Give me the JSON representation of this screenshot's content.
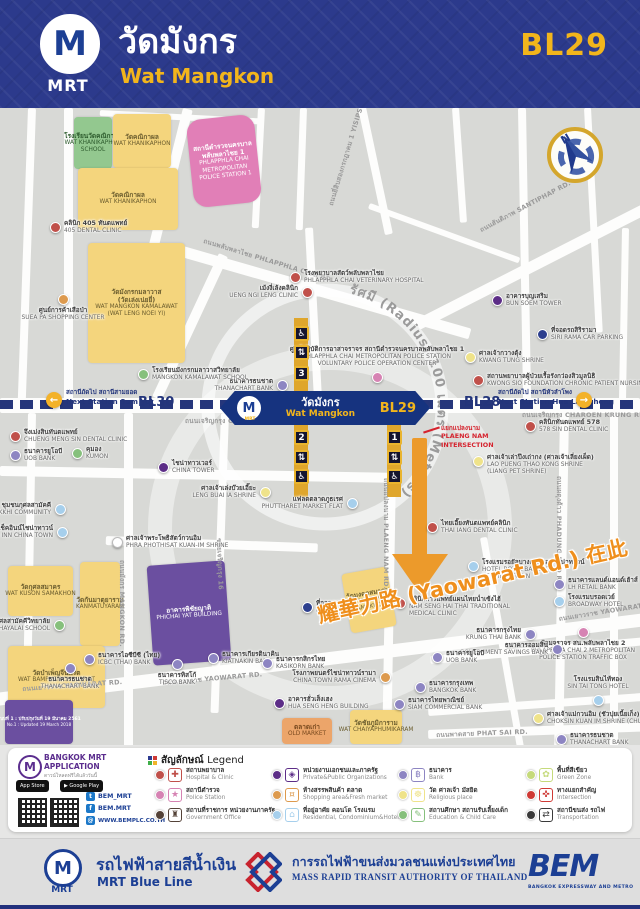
{
  "header": {
    "title_th": "วัดมังกร",
    "title_en": "Wat Mangkon",
    "station_code": "BL29",
    "logo_m": "M",
    "logo_mrt": "MRT"
  },
  "map": {
    "radius_label": "รัศมี (Radius) 100 เมตร (Meters)",
    "compass_n": "N",
    "station": {
      "m": "M",
      "mrt": "MRT",
      "th": "วัดมังกร",
      "en": "Wat Mangkon",
      "code": "BL29"
    },
    "line": {
      "prev_code": "BL30",
      "next_code": "BL28",
      "prev_th": "สถานีถัดไป สถานีสามยอด",
      "prev_en": "Next Station Sam Yot",
      "next_th": "สถานีถัดไป สถานีหัวลำโพง",
      "next_en": "Next Station Hua Lamphong",
      "arrow_left": "←",
      "arrow_right": "→"
    },
    "intersection": {
      "lines": [
        "แยกแปลงนาม",
        "PLAENG NAM",
        "INTERSECTION"
      ]
    },
    "yaowarat_callout": "耀華力路 (Yaowarat Rd.) 在此",
    "note_th": "แบบที่ 1 : ปรับปรุงวันที่ 19 มีนาคม 2561",
    "note_en": "No.1 : Updated 19 March 2018",
    "colors": {
      "hospital": "#c0504a",
      "police": "#d683b3",
      "government": "#544238",
      "private": "#5c2d87",
      "shopping": "#dd9a4e",
      "residential": "#a6cfec",
      "bank": "#8d85c2",
      "religious": "#efe38a",
      "education": "#86c07c",
      "green": "#c5da7b",
      "intersection": "#cf3a35",
      "transport": "#3a3a3a",
      "parking": "#2d3f8e",
      "shrine": "#ffffff"
    },
    "roads": [
      [
        28,
        0,
        8,
        292,
        2
      ],
      [
        64,
        0,
        9,
        292,
        0
      ],
      [
        183,
        0,
        10,
        150,
        14
      ],
      [
        219,
        145,
        10,
        158,
        25
      ],
      [
        358,
        0,
        8,
        130,
        -12
      ],
      [
        258,
        0,
        7,
        120,
        3
      ],
      [
        305,
        120,
        8,
        175,
        -3
      ],
      [
        300,
        0,
        7,
        122,
        2
      ],
      [
        452,
        0,
        7,
        115,
        -4
      ],
      [
        518,
        0,
        8,
        295,
        -1
      ],
      [
        584,
        0,
        7,
        225,
        -3
      ],
      [
        622,
        120,
        7,
        175,
        1
      ],
      [
        415,
        212,
        255,
        11,
        -27
      ],
      [
        183,
        138,
        300,
        11,
        16
      ],
      [
        370,
        95,
        160,
        6,
        20
      ],
      [
        100,
        2,
        160,
        6,
        3
      ],
      [
        0,
        290,
        640,
        15,
        0
      ],
      [
        28,
        305,
        8,
        300,
        1
      ],
      [
        124,
        305,
        9,
        340,
        0
      ],
      [
        221,
        305,
        8,
        300,
        2
      ],
      [
        388,
        305,
        9,
        300,
        1
      ],
      [
        560,
        305,
        9,
        345,
        1
      ],
      [
        610,
        305,
        8,
        340,
        0
      ],
      [
        0,
        358,
        392,
        10,
        1
      ],
      [
        106,
        428,
        212,
        9,
        2
      ],
      [
        -5,
        585,
        660,
        13,
        -7
      ],
      [
        428,
        622,
        215,
        9,
        -2
      ],
      [
        430,
        548,
        215,
        8,
        -5
      ],
      [
        428,
        600,
        218,
        8,
        -4
      ],
      [
        480,
        430,
        7,
        230,
        -10
      ]
    ],
    "road_labels": [
      {
        "x": 205,
        "y": 128,
        "r": 17,
        "t": "ถนนพลับพลาไชย PHLAPPHLA CHAI RD."
      },
      {
        "x": 326,
        "y": 96,
        "r": -73,
        "t": "ถนนยี่สิบสองกรกฎาคม 1 YISIPSONG KARAKADAKHOM 1 RD."
      },
      {
        "x": 478,
        "y": 118,
        "r": -28,
        "t": "ถนนสันติภาพ SANTIPHAP RD."
      },
      {
        "x": 185,
        "y": 308,
        "r": 0,
        "t": "ถนนเจริญกรุง CHAROEN KRUNG RD."
      },
      {
        "x": 522,
        "y": 302,
        "r": 0,
        "t": "ถนนเจริญกรุง CHAROEN KRUNG RD."
      },
      {
        "x": 22,
        "y": 576,
        "r": -4,
        "t": "ถนนเยาวราช YAOWARAT RD."
      },
      {
        "x": 162,
        "y": 570,
        "r": -5,
        "t": "ถนนเยาวราช YAOWARAT RD."
      },
      {
        "x": 558,
        "y": 506,
        "r": -9,
        "t": "ถนนเยาวราช YAOWARAT RD."
      },
      {
        "x": 391,
        "y": 370,
        "r": 90,
        "t": "ถนนแปลงนาม PLAENG NAM RD."
      },
      {
        "x": 564,
        "y": 368,
        "r": 90,
        "t": "ถนนผดุงด้าว PHADUNG DAO RD."
      },
      {
        "x": 127,
        "y": 452,
        "r": 90,
        "t": "ถนนมังกร MANGKON RD."
      },
      {
        "x": 224,
        "y": 430,
        "r": 88,
        "t": "ซอยเจริญกรุง 16"
      },
      {
        "x": 436,
        "y": 622,
        "r": -2,
        "t": "ถนนพาดสาย PHAT SAI RD."
      }
    ],
    "buildings": [
      {
        "x": 74,
        "y": 9,
        "w": 38,
        "h": 52,
        "c": "school",
        "th": "โรงเรียนวัดคณิกาผล",
        "en": "WAT KHANIKAPHON|SCHOOL"
      },
      {
        "x": 113,
        "y": 6,
        "w": 58,
        "h": 54,
        "c": "temple",
        "th": "วัดคณิกาผล",
        "en": "WAT KHANIKAPHON"
      },
      {
        "x": 78,
        "y": 60,
        "w": 100,
        "h": 62,
        "c": "temple",
        "th": "วัดคณิกาผล",
        "en": "WAT KHANIKAPHON"
      },
      {
        "x": 190,
        "y": 9,
        "w": 68,
        "h": 88,
        "c": "police",
        "rot": -6,
        "r": 14,
        "th": "สถานีตำรวจนครบาล|พลับพลาไชย 1",
        "en": "PHLAPPHLA CHAI|METROPOLITAN|POLICE STATION 1"
      },
      {
        "x": 88,
        "y": 135,
        "w": 97,
        "h": 120,
        "c": "temple",
        "th": "วัดมังกรกมลาวาส|(วัดเล่งเน่ยยี่)",
        "en": "WAT MANGKON KAMALAWAT|(WAT LENG NOEI YI)"
      },
      {
        "x": 150,
        "y": 455,
        "w": 78,
        "h": 100,
        "c": "purple",
        "rot": -4,
        "th": "อาคารพิชัยญาติ",
        "en": "PHICHAI YAT BUILDING"
      },
      {
        "x": 8,
        "y": 458,
        "w": 65,
        "h": 50,
        "c": "temple",
        "th": "วัดกุศลสมาคร",
        "en": "WAT KUSON SAMAKHON"
      },
      {
        "x": 80,
        "y": 454,
        "w": 40,
        "h": 84,
        "c": "temple",
        "th": "วัดกันมาตุยาราม",
        "en": "KANMATUYARAM"
      },
      {
        "x": 8,
        "y": 538,
        "w": 97,
        "h": 62,
        "c": "temple",
        "th": "วัดบำเพ็ญจีนพรต",
        "en": "WAT BAMPHEN CHIN PROT"
      },
      {
        "x": 5,
        "y": 592,
        "w": 68,
        "h": 44,
        "c": "purple",
        "note": true
      },
      {
        "x": 346,
        "y": 462,
        "w": 46,
        "h": 60,
        "c": "temple",
        "rot": -10,
        "th": "วัดมงคลสมาคม",
        "en": "WAT MONGKHON|SAMAKHOM"
      },
      {
        "x": 350,
        "y": 602,
        "w": 52,
        "h": 34,
        "c": "temple",
        "th": "วัดชัยภูมิการาม",
        "en": "WAT CHAIYAPHUMIKARAM"
      },
      {
        "x": 282,
        "y": 610,
        "w": 50,
        "h": 26,
        "c": "market",
        "th": "ตลาดเก่า",
        "en": "OLD MARKET"
      }
    ],
    "pois": [
      {
        "x": 55,
        "y": 119,
        "c": "hospital",
        "th": "คลินิก 405 ทันตแพทย์",
        "en": "405 DENTAL CLINIC"
      },
      {
        "x": 63,
        "y": 191,
        "c": "shopping",
        "s": "b",
        "th": "ศูนย์การค้าเสือป่า",
        "en": "SUEA PA SHOPPING CENTER"
      },
      {
        "x": 295,
        "y": 169,
        "c": "hospital",
        "th": "โรงพยาบาลสัตว์พลับพลาไชย",
        "en": "PHLAPPHLA CHAI VETERINARY HOSPITAL"
      },
      {
        "x": 307,
        "y": 184,
        "c": "hospital",
        "s": "l",
        "th": "เม้งงี่เล้งคลินิก",
        "en": "UENG NGI LENG CLINIC"
      },
      {
        "x": 497,
        "y": 192,
        "c": "private",
        "th": "อาคารบุญเสริม",
        "en": "BUN SOEM TOWER"
      },
      {
        "x": 542,
        "y": 226,
        "c": "parking",
        "th": "ที่จอดรถสิริรามา",
        "en": "SIRI RAMA CAR PARKING"
      },
      {
        "x": 470,
        "y": 249,
        "c": "religious",
        "th": "ศาลเจ้ากวางตุ้ง",
        "en": "KWANG TUNG SHRINE"
      },
      {
        "x": 478,
        "y": 272,
        "c": "hospital",
        "th": "สถานพยาบาลผู้ป่วยเรื้อรังกว่องสิวมูลนิธิ",
        "en": "KWONG SIO FOUNDATION CHRONIC PATIENT NURSING HOME"
      },
      {
        "x": 282,
        "y": 277,
        "c": "bank",
        "s": "l",
        "th": "ธนาคารธนชาต",
        "en": "THANACHART BANK"
      },
      {
        "x": 143,
        "y": 266,
        "c": "education",
        "th": "โรงเรียนมังกรกมลาวาสวิทยาลัย",
        "en": "MANGKON KAMALAWAT SCHOOL"
      },
      {
        "x": 377,
        "y": 269,
        "c": "police",
        "s": "a",
        "th": "ศูนย์ปฏิบัติการอาสาจราจร สถานีตำรวจนครบาลพลับพลาไชย 1",
        "en": "PHLAPPHLA CHAI METROPOLITAN POLICE STATION|VOLUNTARY POLICE OPERATION CENTER"
      },
      {
        "x": 530,
        "y": 318,
        "c": "hospital",
        "th": "คลินิกทันตแพทย์ 578",
        "en": "578 SIN DENTAL CLINIC"
      },
      {
        "x": 15,
        "y": 328,
        "c": "hospital",
        "th": "จึงเม่งสินทันตแพทย์",
        "en": "CHUENG MENG SIN DENTAL CLINIC"
      },
      {
        "x": 15,
        "y": 347,
        "c": "bank",
        "th": "ธนาคารยูโอบี",
        "en": "UOB BANK"
      },
      {
        "x": 77,
        "y": 345,
        "c": "education",
        "th": "คุมอง",
        "en": "KUMON"
      },
      {
        "x": 163,
        "y": 359,
        "c": "private",
        "th": "ไชน่าทาวเวอร์",
        "en": "CHINA TOWER"
      },
      {
        "x": 60,
        "y": 401,
        "c": "residential",
        "s": "l",
        "th": "ชุมชนกุศลสามัคคี",
        "en": "KHUSON SAMAKKHI COMMUNITY"
      },
      {
        "x": 62,
        "y": 424,
        "c": "residential",
        "s": "l",
        "th": "เช็คอินน์ไชน่าทาวน์",
        "en": "CHECK INN CHINA TOWN"
      },
      {
        "x": 265,
        "y": 384,
        "c": "religious",
        "s": "l",
        "th": "ศาลเจ้าเล่งบ๊วยเอี๊ยะ",
        "en": "LENG BUAI IA SHRINE"
      },
      {
        "x": 117,
        "y": 434,
        "c": "shrine",
        "th": "ศาลเจ้าพระโพธิสัตว์กวนอิม",
        "en": "PHRA PHOTHISAT KUAN-IM SHRINE"
      },
      {
        "x": 352,
        "y": 395,
        "c": "residential",
        "s": "l",
        "th": "แฟลตตลาดภูธเรศ",
        "en": "PHUTTHARET MARKET FLAT"
      },
      {
        "x": 478,
        "y": 353,
        "c": "religious",
        "th": "ศาลเจ้าเล่าปึงเถ่ากง (ศาลเจ้าเลี่ยงเผ็ด)",
        "en": "LAO PUENG THAO KONG SHRINE|(LIANG PET SHRINE)"
      },
      {
        "x": 432,
        "y": 419,
        "c": "hospital",
        "th": "ไทยเอี๊ยงทันตแพทย์คลินิก",
        "en": "THAI IANG DENTAL CLINIC"
      },
      {
        "x": 473,
        "y": 458,
        "c": "residential",
        "th": "โรงแรมรอยัลบางกอกแอทไชน่าทาวน์",
        "en": "HOTEL ROYAL BANGKOK|AT CHINA TOWN"
      },
      {
        "x": 559,
        "y": 476,
        "c": "bank",
        "th": "ธนาคารแลนด์แอนด์เฮ้าส์",
        "en": "LH RETAIL BANK"
      },
      {
        "x": 559,
        "y": 493,
        "c": "residential",
        "th": "โรงแรมบรอดเวย์",
        "en": "BROADWAY HOTEL"
      },
      {
        "x": 400,
        "y": 495,
        "c": "hospital",
        "th": "คลินิกการแพทย์แผนไทยน่ำเซ้งไฮ้",
        "en": "NAM SENG HAI THAI TRADITIONAL|MEDICAL CLINIC"
      },
      {
        "x": 530,
        "y": 526,
        "c": "bank",
        "s": "l",
        "th": "ธนาคารกรุงไทย",
        "en": "KRUNG THAI BANK"
      },
      {
        "x": 583,
        "y": 524,
        "c": "police",
        "s": "b",
        "th": "ป้อมจราจร สน.พลับพลาไชย 2",
        "en": "PHLAPPHLA CHAI 2 METROPOLITAN|POLICE STATION TRAFFIC BOX"
      },
      {
        "x": 557,
        "y": 541,
        "c": "bank",
        "s": "l",
        "th": "ธนาคารออมสิน",
        "en": "GOVERNMENT SAVINGS BANK"
      },
      {
        "x": 437,
        "y": 549,
        "c": "bank",
        "th": "ธนาคารยูโอบี",
        "en": "UOB BANK"
      },
      {
        "x": 420,
        "y": 579,
        "c": "bank",
        "th": "ธนาคารกรุงเทพ",
        "en": "BANGKOK BANK"
      },
      {
        "x": 399,
        "y": 596,
        "c": "bank",
        "th": "ธนาคารไทยพาณิชย์",
        "en": "SIAM COMMERCIAL BANK"
      },
      {
        "x": 385,
        "y": 569,
        "c": "shopping",
        "s": "l",
        "th": "โรงภาพยนตร์ไชน่าทาวน์รามา",
        "en": "CHINA TOWN RAMA CINEMA"
      },
      {
        "x": 598,
        "y": 592,
        "c": "residential",
        "s": "a",
        "th": "โรงแรมสินไท้ทอง",
        "en": "SIN TAI TONG HOTEL"
      },
      {
        "x": 538,
        "y": 610,
        "c": "religious",
        "th": "ศาลเจ้าแม่กวนอิม (ชัวปุยเนี้ยเก็ง)",
        "en": "CHOKSIN KUAN IM SHRINE (CHUA PUI NIA YIA)"
      },
      {
        "x": 561,
        "y": 631,
        "c": "bank",
        "th": "ธนาคารธนชาต",
        "en": "THANACHART BANK"
      },
      {
        "x": 279,
        "y": 595,
        "c": "private",
        "th": "อาคารฮั่วเส็งเฮง",
        "en": "HUA SENG HENG BUILDING"
      },
      {
        "x": 307,
        "y": 499,
        "c": "parking",
        "th": "ที่จอดรถ",
        "en": "PARKING"
      },
      {
        "x": 59,
        "y": 517,
        "c": "education",
        "s": "l",
        "th": "โรงเรียนกุศลสามัคคีวิทยาลัย",
        "en": "KUSONSAMAKKHI WITTHAYALAI SCHOOL"
      },
      {
        "x": 89,
        "y": 551,
        "c": "bank",
        "th": "ธนาคารไอซีบีซี (ไทย)",
        "en": "ICBC (THAI) BANK"
      },
      {
        "x": 70,
        "y": 560,
        "c": "bank",
        "s": "b",
        "th": "ธนาคารธนชาต",
        "en": "THANACHART BANK"
      },
      {
        "x": 177,
        "y": 556,
        "c": "bank",
        "s": "b",
        "th": "ธนาคารทิสโก้",
        "en": "TISCO BANK"
      },
      {
        "x": 213,
        "y": 550,
        "c": "bank",
        "th": "ธนาคารเกียรตินาคิน",
        "en": "KIATNAKIN BANK"
      },
      {
        "x": 267,
        "y": 555,
        "c": "bank",
        "th": "ธนาคารกสิกรไทย",
        "en": "KASIKORN BANK"
      }
    ],
    "exits": [
      {
        "n": "3",
        "x": 294,
        "stemY": 210,
        "stemH": 76,
        "order": [
          "wc",
          "lift",
          "num"
        ],
        "iconY": [
          218,
          237,
          258
        ]
      },
      {
        "n": "2",
        "x": 294,
        "stemY": 317,
        "stemH": 72,
        "order": [
          "num",
          "lift",
          "wc"
        ],
        "iconY": [
          322,
          342,
          361
        ]
      },
      {
        "n": "1",
        "x": 387,
        "stemY": 317,
        "stemH": 72,
        "order": [
          "num",
          "lift",
          "wc"
        ],
        "iconY": [
          322,
          342,
          361
        ]
      }
    ]
  },
  "icons": {
    "wheelchair": "♿",
    "elevator": "⇅",
    "twitter": "t",
    "facebook": "f",
    "web": "@",
    "legend_hospital": "✚",
    "legend_police": "★",
    "legend_government": "♜",
    "legend_private": "◈",
    "legend_shopping": "¤",
    "legend_residential": "⌂",
    "legend_bank": "฿",
    "legend_religious": "☸",
    "legend_education": "✎",
    "legend_green": "✿",
    "legend_intersection": "✜",
    "legend_transport": "⇄"
  },
  "legend": {
    "title_th": "สัญลักษณ์",
    "title_en": "Legend",
    "items": [
      {
        "col": 0,
        "row": 0,
        "c": "hospital",
        "ic": "legend_hospital",
        "th": "สถานพยาบาล",
        "en": "Hospital & Clinic"
      },
      {
        "col": 0,
        "row": 1,
        "c": "police",
        "ic": "legend_police",
        "th": "สถานีตำรวจ",
        "en": "Police Station"
      },
      {
        "col": 0,
        "row": 2,
        "c": "government",
        "ic": "legend_government",
        "th": "สถานที่ราชการ หน่วยงานภาครัฐ",
        "en": "Government Office"
      },
      {
        "col": 1,
        "row": 0,
        "c": "private",
        "ic": "legend_private",
        "th": "หน่วยงานเอกชนและภาครัฐ",
        "en": "Private&Public Organizations"
      },
      {
        "col": 1,
        "row": 1,
        "c": "shopping",
        "ic": "legend_shopping",
        "th": "ห้างสรรพสินค้า ตลาด",
        "en": "Shopping area&Fresh market"
      },
      {
        "col": 1,
        "row": 2,
        "c": "residential",
        "ic": "legend_residential",
        "th": "ที่อยู่อาศัย คอนโด โรงแรม",
        "en": "Residential, Condominium&Hotels"
      },
      {
        "col": 2,
        "row": 0,
        "c": "bank",
        "ic": "legend_bank",
        "th": "ธนาคาร",
        "en": "Bank"
      },
      {
        "col": 2,
        "row": 1,
        "c": "religious",
        "ic": "legend_religious",
        "th": "วัด ศาลเจ้า มัสยิด",
        "en": "Religious place"
      },
      {
        "col": 2,
        "row": 2,
        "c": "education",
        "ic": "legend_education",
        "th": "สถานศึกษา สถานรับเลี้ยงเด็ก",
        "en": "Education & Child Care"
      },
      {
        "col": 3,
        "row": 0,
        "c": "green",
        "ic": "legend_green",
        "th": "พื้นที่สีเขียว",
        "en": "Green Zone"
      },
      {
        "col": 3,
        "row": 1,
        "c": "intersection",
        "ic": "legend_intersection",
        "th": "ทางแยกสำคัญ",
        "en": "Intersection"
      },
      {
        "col": 3,
        "row": 2,
        "c": "transport",
        "ic": "legend_transport",
        "th": "สถานีขนส่ง รถไฟ",
        "en": "Transportation"
      }
    ]
  },
  "app_block": {
    "name_line1": "BANGKOK MRT",
    "name_line2": "APPLICATION",
    "tagline": "ดาวน์โหลดฟรีได้แล้ววันนี้",
    "badge_appstore": "App Store",
    "badge_googleplay": "▶ Google Play",
    "twitter": "BEM_MRT",
    "facebook": "BEM.MRT",
    "website": "WWW.BEMPLC.CO.TH",
    "logo_m": "M"
  },
  "footer": {
    "mrt_m": "M",
    "mrt_label": "MRT",
    "blue_line_th": "รถไฟฟ้าสายสีน้ำเงิน",
    "blue_line_en": "MRT Blue Line",
    "mrta_th": "การรถไฟฟ้าขนส่งมวลชนแห่งประเทศไทย",
    "mrta_en": "MASS RAPID TRANSIT AUTHORITY OF THAILAND",
    "bem": "BEM",
    "bem_sub": "BANGKOK EXPRESSWAY AND METRO"
  }
}
